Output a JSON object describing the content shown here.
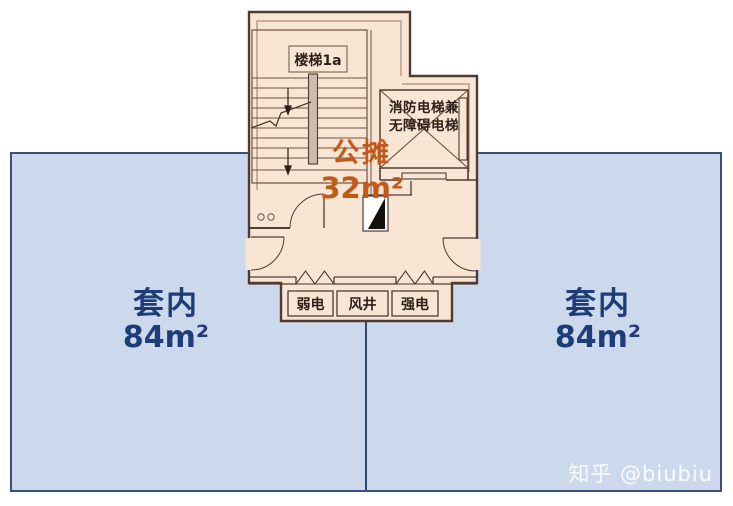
{
  "title": "apartment floor plan - shared core vs. unit areas",
  "colors": {
    "unit_fill": "#ccd9ec",
    "unit_border": "#37517c",
    "unit_text": "#1d3c78",
    "core_fill": "#f9e5d3",
    "core_wall": "#4f3b31",
    "inner_wall": "#8a6a55",
    "shared_text": "#c2591b",
    "wedge_black": "#15100c"
  },
  "units": {
    "left": {
      "label": "套内",
      "area": "84",
      "unit": "m²"
    },
    "right": {
      "label": "套内",
      "area": "84",
      "unit": "m²"
    }
  },
  "shared_area": {
    "label": "公摊",
    "area": "32",
    "unit": "m²"
  },
  "core": {
    "stair_label": "楼梯1a",
    "elevator_label_line1": "消防电梯兼",
    "elevator_label_line2": "无障碍电梯",
    "utility_rooms": [
      {
        "label": "弱电"
      },
      {
        "label": "风井"
      },
      {
        "label": "强电"
      }
    ]
  },
  "watermark": {
    "text": "知乎 @biubiu"
  }
}
